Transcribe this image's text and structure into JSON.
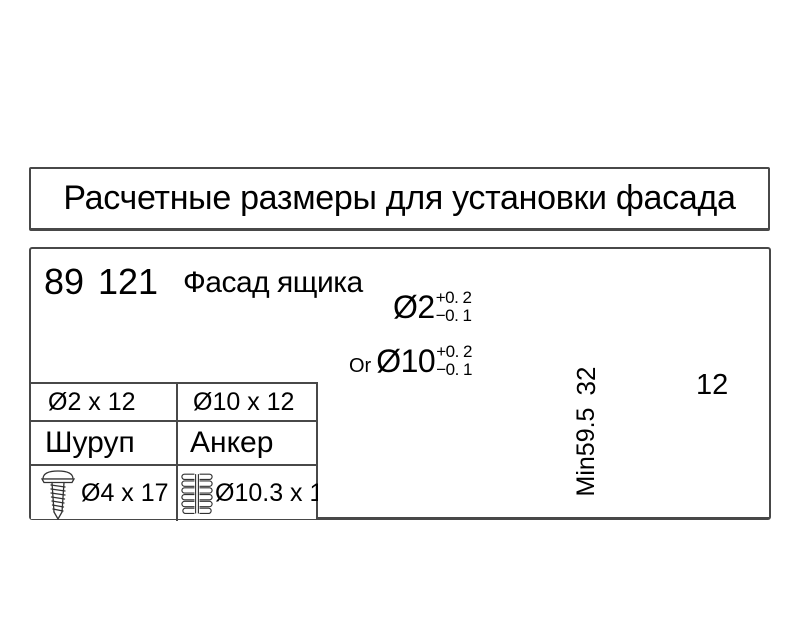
{
  "title": "Расчетные размеры для установки фасада",
  "header": {
    "width_value": "89",
    "height_value": "121",
    "caption": "Фасад ящика"
  },
  "table": {
    "row1": {
      "col1": "Ø2 x 12",
      "col2": "Ø10 x 12"
    },
    "row2": {
      "col1": "Шуруп",
      "col2": "Анкер"
    },
    "row3": {
      "col1": "Ø4 x 17",
      "col2": "Ø10.3 x 10"
    },
    "icons": {
      "col1": "screw-icon",
      "col2": "euro-dowel-icon"
    }
  },
  "diagram": {
    "screw_hole_label": {
      "dia": "Ø2",
      "tol_plus": "+0. 2",
      "tol_minus": "−0. 1"
    },
    "or_text": "Or",
    "anchor_hole_label": {
      "dia": "Ø10",
      "tol_plus": "+0. 2",
      "tol_minus": "−0. 1"
    },
    "dim_hole_spacing": "32",
    "dim_min_height": "Min59.5",
    "dim_hole_depth": "12"
  },
  "colors": {
    "line": "#4d4d4d",
    "border": "#484848",
    "text": "#000000"
  }
}
